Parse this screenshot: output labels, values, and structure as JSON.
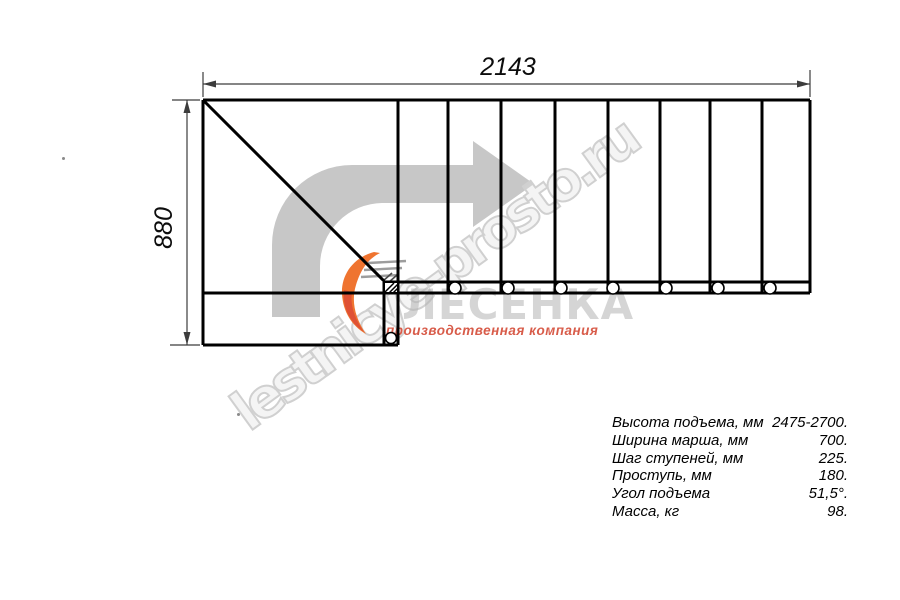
{
  "drawing": {
    "width_label": "2143",
    "height_label": "880"
  },
  "watermark": {
    "text": "lestnicye-prosto.ru"
  },
  "logo": {
    "name": "ЛЕСЕНКА",
    "tagline": "производственная компания"
  },
  "specs": {
    "rows": [
      {
        "label": "Высота подъема, мм",
        "value": "2475-2700."
      },
      {
        "label": "Ширина марша, мм",
        "value": "700."
      },
      {
        "label": "Шаг ступеней, мм",
        "value": "225."
      },
      {
        "label": "Проступь, мм",
        "value": "180."
      },
      {
        "label": "Угол подъема",
        "value": "51,5°."
      },
      {
        "label": "Масса, кг",
        "value": "98."
      }
    ]
  },
  "colors": {
    "line": "#000000",
    "dimension": "#3c3c3c",
    "arrow_fill": "#c7c7c7",
    "watermark_stroke": "#d0d0d0",
    "logo_gray": "#b3b3b3",
    "logo_orange": "#ef7430",
    "logo_red": "#df5134",
    "tagline_red": "#d85c4a"
  }
}
